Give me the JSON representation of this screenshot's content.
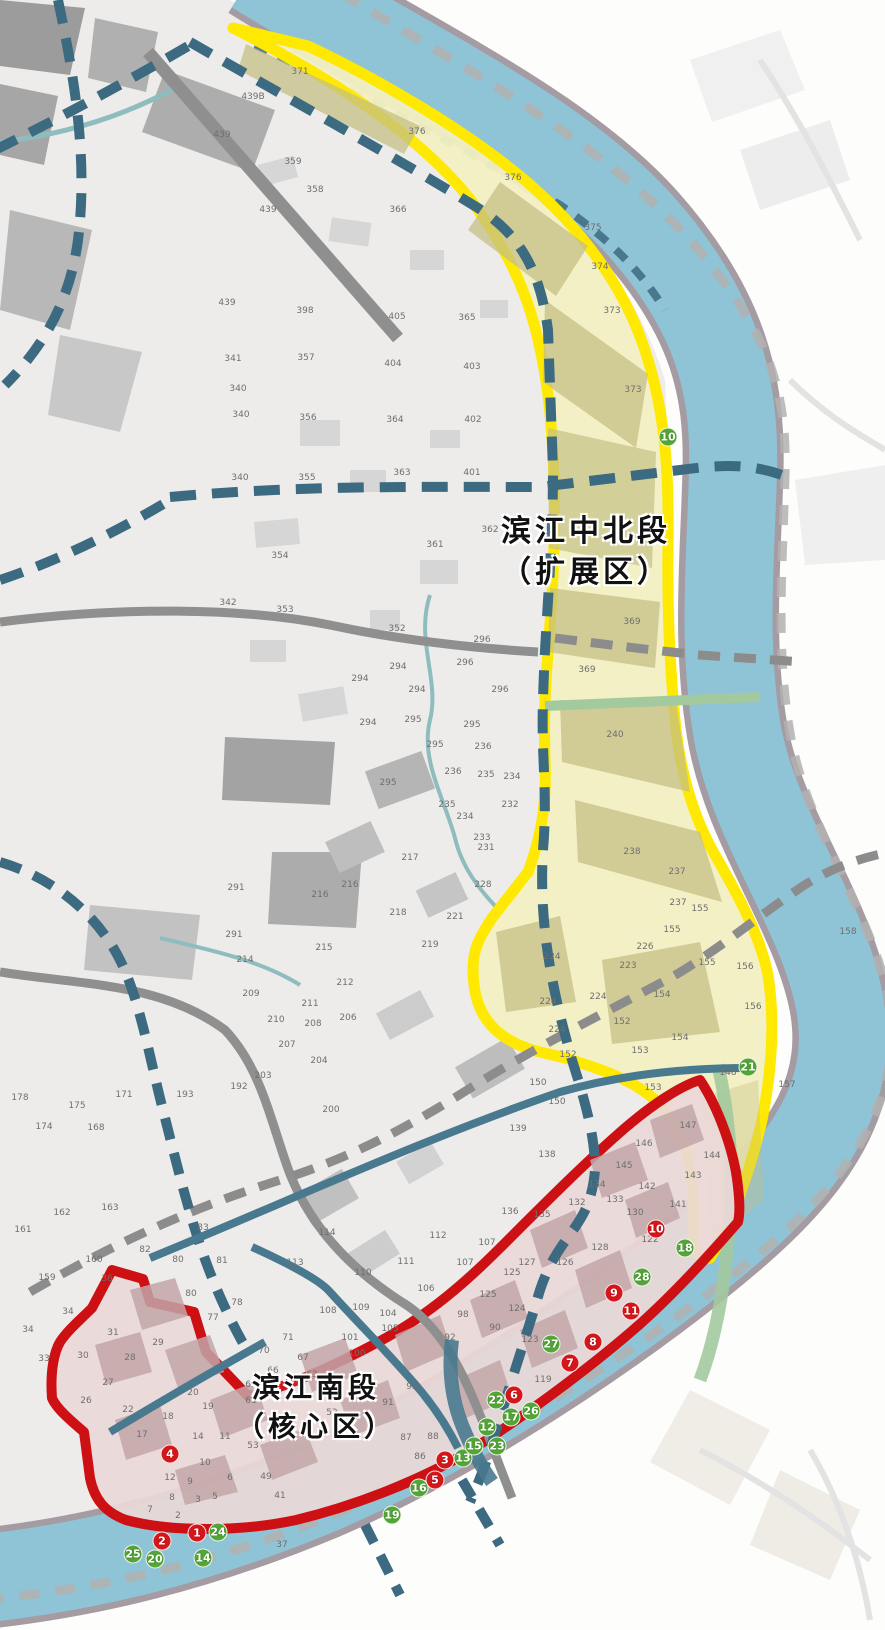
{
  "zones": [
    {
      "id": "north",
      "name_line1": "滨江中北段",
      "name_line2": "（扩展区）"
    },
    {
      "id": "south",
      "name_line1": "滨江南段",
      "name_line2": "（核心区）"
    }
  ],
  "colors": {
    "river": "#8FC3D6",
    "shore": "#A49BA3",
    "far_bank_dash": "#B3B1B0",
    "map_base": "#EDECEA",
    "zone_north_border": "#FFE802",
    "zone_north_fill": "#F1EFC2",
    "zone_north_block": "#C6C186",
    "zone_south_border": "#CC1014",
    "zone_south_fill": "#EBD8D8",
    "zone_south_block": "#C3A6A8",
    "road_dashed_blue": "#3C6A81",
    "road_gray": "#8F8F8F",
    "road_dashed_gray": "#8C8C8C",
    "road_teal": "#48798E",
    "canal": "#8FBCBE",
    "green_strip": "#A3C99F",
    "marker_red": "#D5161A",
    "marker_green": "#53A637",
    "parcel_text": "#6F6F6F",
    "zone_label_text": "#111111"
  },
  "markers": {
    "red": [
      {
        "n": "1",
        "x": 197,
        "y": 1533
      },
      {
        "n": "2",
        "x": 162,
        "y": 1541
      },
      {
        "n": "3",
        "x": 445,
        "y": 1460
      },
      {
        "n": "4",
        "x": 170,
        "y": 1454
      },
      {
        "n": "5",
        "x": 435,
        "y": 1480
      },
      {
        "n": "6",
        "x": 514,
        "y": 1395
      },
      {
        "n": "7",
        "x": 570,
        "y": 1363
      },
      {
        "n": "8",
        "x": 593,
        "y": 1342
      },
      {
        "n": "9",
        "x": 614,
        "y": 1293
      },
      {
        "n": "10",
        "x": 656,
        "y": 1229
      },
      {
        "n": "11",
        "x": 631,
        "y": 1311
      }
    ],
    "green": [
      {
        "n": "10",
        "x": 668,
        "y": 437
      },
      {
        "n": "12",
        "x": 487,
        "y": 1427
      },
      {
        "n": "13",
        "x": 463,
        "y": 1458
      },
      {
        "n": "14",
        "x": 203,
        "y": 1558
      },
      {
        "n": "15",
        "x": 474,
        "y": 1446
      },
      {
        "n": "16",
        "x": 419,
        "y": 1488
      },
      {
        "n": "17",
        "x": 511,
        "y": 1417
      },
      {
        "n": "18",
        "x": 685,
        "y": 1248
      },
      {
        "n": "19",
        "x": 392,
        "y": 1515
      },
      {
        "n": "20",
        "x": 155,
        "y": 1559
      },
      {
        "n": "21",
        "x": 748,
        "y": 1067
      },
      {
        "n": "22",
        "x": 496,
        "y": 1400
      },
      {
        "n": "23",
        "x": 497,
        "y": 1446
      },
      {
        "n": "24",
        "x": 218,
        "y": 1532
      },
      {
        "n": "25",
        "x": 133,
        "y": 1554
      },
      {
        "n": "26",
        "x": 531,
        "y": 1411
      },
      {
        "n": "27",
        "x": 551,
        "y": 1344
      },
      {
        "n": "28",
        "x": 642,
        "y": 1277
      }
    ]
  },
  "parcel_labels": [
    {
      "t": "439B",
      "x": 253,
      "y": 97
    },
    {
      "t": "439",
      "x": 222,
      "y": 135
    },
    {
      "t": "359",
      "x": 293,
      "y": 162
    },
    {
      "t": "358",
      "x": 315,
      "y": 190
    },
    {
      "t": "439",
      "x": 268,
      "y": 210
    },
    {
      "t": "366",
      "x": 398,
      "y": 210
    },
    {
      "t": "376",
      "x": 417,
      "y": 132
    },
    {
      "t": "376",
      "x": 513,
      "y": 178
    },
    {
      "t": "375",
      "x": 593,
      "y": 228
    },
    {
      "t": "374",
      "x": 600,
      "y": 267
    },
    {
      "t": "373",
      "x": 612,
      "y": 311
    },
    {
      "t": "373",
      "x": 633,
      "y": 390
    },
    {
      "t": "371",
      "x": 300,
      "y": 72
    },
    {
      "t": "439",
      "x": 227,
      "y": 303
    },
    {
      "t": "398",
      "x": 305,
      "y": 311
    },
    {
      "t": "405",
      "x": 397,
      "y": 317
    },
    {
      "t": "365",
      "x": 467,
      "y": 318
    },
    {
      "t": "341",
      "x": 233,
      "y": 359
    },
    {
      "t": "357",
      "x": 306,
      "y": 358
    },
    {
      "t": "404",
      "x": 393,
      "y": 364
    },
    {
      "t": "403",
      "x": 472,
      "y": 367
    },
    {
      "t": "340",
      "x": 238,
      "y": 389
    },
    {
      "t": "340",
      "x": 241,
      "y": 415
    },
    {
      "t": "356",
      "x": 308,
      "y": 418
    },
    {
      "t": "364",
      "x": 395,
      "y": 420
    },
    {
      "t": "402",
      "x": 473,
      "y": 420
    },
    {
      "t": "340",
      "x": 240,
      "y": 478
    },
    {
      "t": "355",
      "x": 307,
      "y": 478
    },
    {
      "t": "363",
      "x": 402,
      "y": 473
    },
    {
      "t": "401",
      "x": 472,
      "y": 473
    },
    {
      "t": "354",
      "x": 280,
      "y": 556
    },
    {
      "t": "353",
      "x": 285,
      "y": 610
    },
    {
      "t": "342",
      "x": 228,
      "y": 603
    },
    {
      "t": "362",
      "x": 490,
      "y": 530
    },
    {
      "t": "361",
      "x": 435,
      "y": 545
    },
    {
      "t": "372",
      "x": 653,
      "y": 529
    },
    {
      "t": "352",
      "x": 397,
      "y": 629
    },
    {
      "t": "296",
      "x": 482,
      "y": 640
    },
    {
      "t": "296",
      "x": 465,
      "y": 663
    },
    {
      "t": "296",
      "x": 500,
      "y": 690
    },
    {
      "t": "294",
      "x": 398,
      "y": 667
    },
    {
      "t": "294",
      "x": 360,
      "y": 679
    },
    {
      "t": "294",
      "x": 417,
      "y": 690
    },
    {
      "t": "294",
      "x": 368,
      "y": 723
    },
    {
      "t": "295",
      "x": 413,
      "y": 720
    },
    {
      "t": "295",
      "x": 472,
      "y": 725
    },
    {
      "t": "295",
      "x": 435,
      "y": 745
    },
    {
      "t": "295",
      "x": 388,
      "y": 783
    },
    {
      "t": "236",
      "x": 483,
      "y": 747
    },
    {
      "t": "236",
      "x": 453,
      "y": 772
    },
    {
      "t": "235",
      "x": 486,
      "y": 775
    },
    {
      "t": "235",
      "x": 447,
      "y": 805
    },
    {
      "t": "234",
      "x": 512,
      "y": 777
    },
    {
      "t": "234",
      "x": 465,
      "y": 817
    },
    {
      "t": "233",
      "x": 482,
      "y": 838
    },
    {
      "t": "232",
      "x": 510,
      "y": 805
    },
    {
      "t": "217",
      "x": 410,
      "y": 858
    },
    {
      "t": "231",
      "x": 486,
      "y": 848
    },
    {
      "t": "216",
      "x": 350,
      "y": 885
    },
    {
      "t": "218",
      "x": 398,
      "y": 913
    },
    {
      "t": "221",
      "x": 455,
      "y": 917
    },
    {
      "t": "219",
      "x": 430,
      "y": 945
    },
    {
      "t": "228",
      "x": 483,
      "y": 885
    },
    {
      "t": "369",
      "x": 587,
      "y": 670
    },
    {
      "t": "369",
      "x": 632,
      "y": 622
    },
    {
      "t": "240",
      "x": 615,
      "y": 735
    },
    {
      "t": "238",
      "x": 632,
      "y": 852
    },
    {
      "t": "237",
      "x": 677,
      "y": 872
    },
    {
      "t": "237",
      "x": 678,
      "y": 903
    },
    {
      "t": "155",
      "x": 700,
      "y": 909
    },
    {
      "t": "155",
      "x": 672,
      "y": 930
    },
    {
      "t": "155",
      "x": 707,
      "y": 963
    },
    {
      "t": "156",
      "x": 745,
      "y": 967
    },
    {
      "t": "156",
      "x": 753,
      "y": 1007
    },
    {
      "t": "158",
      "x": 848,
      "y": 932
    },
    {
      "t": "157",
      "x": 787,
      "y": 1085
    },
    {
      "t": "224",
      "x": 552,
      "y": 957
    },
    {
      "t": "224",
      "x": 548,
      "y": 1002
    },
    {
      "t": "224",
      "x": 598,
      "y": 997
    },
    {
      "t": "224",
      "x": 557,
      "y": 1030
    },
    {
      "t": "223",
      "x": 628,
      "y": 966
    },
    {
      "t": "226",
      "x": 645,
      "y": 947
    },
    {
      "t": "152",
      "x": 622,
      "y": 1022
    },
    {
      "t": "152",
      "x": 568,
      "y": 1055
    },
    {
      "t": "153",
      "x": 640,
      "y": 1051
    },
    {
      "t": "153",
      "x": 653,
      "y": 1088
    },
    {
      "t": "154",
      "x": 662,
      "y": 995
    },
    {
      "t": "154",
      "x": 680,
      "y": 1038
    },
    {
      "t": "150",
      "x": 538,
      "y": 1083
    },
    {
      "t": "150",
      "x": 557,
      "y": 1102
    },
    {
      "t": "148",
      "x": 728,
      "y": 1073
    },
    {
      "t": "291",
      "x": 236,
      "y": 888
    },
    {
      "t": "291",
      "x": 234,
      "y": 935
    },
    {
      "t": "214",
      "x": 245,
      "y": 960
    },
    {
      "t": "215",
      "x": 324,
      "y": 948
    },
    {
      "t": "216",
      "x": 320,
      "y": 895
    },
    {
      "t": "212",
      "x": 345,
      "y": 983
    },
    {
      "t": "209",
      "x": 251,
      "y": 994
    },
    {
      "t": "210",
      "x": 276,
      "y": 1020
    },
    {
      "t": "211",
      "x": 310,
      "y": 1004
    },
    {
      "t": "208",
      "x": 313,
      "y": 1024
    },
    {
      "t": "207",
      "x": 287,
      "y": 1045
    },
    {
      "t": "206",
      "x": 348,
      "y": 1018
    },
    {
      "t": "204",
      "x": 319,
      "y": 1061
    },
    {
      "t": "203",
      "x": 263,
      "y": 1076
    },
    {
      "t": "200",
      "x": 331,
      "y": 1110
    },
    {
      "t": "193",
      "x": 185,
      "y": 1095
    },
    {
      "t": "192",
      "x": 239,
      "y": 1087
    },
    {
      "t": "171",
      "x": 124,
      "y": 1095
    },
    {
      "t": "175",
      "x": 77,
      "y": 1106
    },
    {
      "t": "178",
      "x": 20,
      "y": 1098
    },
    {
      "t": "174",
      "x": 44,
      "y": 1127
    },
    {
      "t": "168",
      "x": 96,
      "y": 1128
    },
    {
      "t": "162",
      "x": 62,
      "y": 1213
    },
    {
      "t": "163",
      "x": 110,
      "y": 1208
    },
    {
      "t": "161",
      "x": 23,
      "y": 1230
    },
    {
      "t": "159",
      "x": 47,
      "y": 1278
    },
    {
      "t": "160",
      "x": 94,
      "y": 1260
    },
    {
      "t": "36",
      "x": 107,
      "y": 1279
    },
    {
      "t": "34",
      "x": 68,
      "y": 1312
    },
    {
      "t": "34",
      "x": 28,
      "y": 1330
    },
    {
      "t": "80",
      "x": 178,
      "y": 1260
    },
    {
      "t": "80",
      "x": 191,
      "y": 1294
    },
    {
      "t": "81",
      "x": 222,
      "y": 1261
    },
    {
      "t": "78",
      "x": 237,
      "y": 1303
    },
    {
      "t": "77",
      "x": 213,
      "y": 1318
    },
    {
      "t": "83",
      "x": 203,
      "y": 1228
    },
    {
      "t": "82",
      "x": 145,
      "y": 1250
    },
    {
      "t": "31",
      "x": 113,
      "y": 1333
    },
    {
      "t": "30",
      "x": 83,
      "y": 1356
    },
    {
      "t": "33",
      "x": 44,
      "y": 1359
    },
    {
      "t": "29",
      "x": 158,
      "y": 1343
    },
    {
      "t": "28",
      "x": 130,
      "y": 1358
    },
    {
      "t": "27",
      "x": 108,
      "y": 1383
    },
    {
      "t": "26",
      "x": 86,
      "y": 1401
    },
    {
      "t": "22",
      "x": 128,
      "y": 1410
    },
    {
      "t": "18",
      "x": 168,
      "y": 1417
    },
    {
      "t": "19",
      "x": 208,
      "y": 1407
    },
    {
      "t": "20",
      "x": 193,
      "y": 1393
    },
    {
      "t": "113",
      "x": 295,
      "y": 1263
    },
    {
      "t": "114",
      "x": 327,
      "y": 1233
    },
    {
      "t": "110",
      "x": 363,
      "y": 1273
    },
    {
      "t": "112",
      "x": 438,
      "y": 1236
    },
    {
      "t": "111",
      "x": 406,
      "y": 1262
    },
    {
      "t": "107",
      "x": 487,
      "y": 1243
    },
    {
      "t": "107",
      "x": 465,
      "y": 1263
    },
    {
      "t": "106",
      "x": 426,
      "y": 1289
    },
    {
      "t": "108",
      "x": 328,
      "y": 1311
    },
    {
      "t": "109",
      "x": 361,
      "y": 1308
    },
    {
      "t": "104",
      "x": 388,
      "y": 1314
    },
    {
      "t": "105",
      "x": 390,
      "y": 1329
    },
    {
      "t": "101",
      "x": 350,
      "y": 1338
    },
    {
      "t": "100",
      "x": 357,
      "y": 1354
    },
    {
      "t": "71",
      "x": 288,
      "y": 1338
    },
    {
      "t": "70",
      "x": 264,
      "y": 1351
    },
    {
      "t": "67",
      "x": 303,
      "y": 1358
    },
    {
      "t": "66",
      "x": 273,
      "y": 1371
    },
    {
      "t": "63",
      "x": 312,
      "y": 1375
    },
    {
      "t": "65",
      "x": 251,
      "y": 1385
    },
    {
      "t": "61",
      "x": 251,
      "y": 1401
    },
    {
      "t": "52",
      "x": 332,
      "y": 1413
    },
    {
      "t": "93",
      "x": 412,
      "y": 1387
    },
    {
      "t": "91",
      "x": 388,
      "y": 1403
    },
    {
      "t": "92",
      "x": 450,
      "y": 1338
    },
    {
      "t": "88",
      "x": 433,
      "y": 1437
    },
    {
      "t": "87",
      "x": 406,
      "y": 1438
    },
    {
      "t": "86",
      "x": 420,
      "y": 1457
    },
    {
      "t": "125",
      "x": 512,
      "y": 1273
    },
    {
      "t": "125",
      "x": 488,
      "y": 1295
    },
    {
      "t": "124",
      "x": 517,
      "y": 1309
    },
    {
      "t": "98",
      "x": 463,
      "y": 1315
    },
    {
      "t": "90",
      "x": 495,
      "y": 1328
    },
    {
      "t": "123",
      "x": 530,
      "y": 1340
    },
    {
      "t": "119",
      "x": 543,
      "y": 1380
    },
    {
      "t": "147",
      "x": 688,
      "y": 1126
    },
    {
      "t": "146",
      "x": 644,
      "y": 1144
    },
    {
      "t": "144",
      "x": 712,
      "y": 1156
    },
    {
      "t": "145",
      "x": 624,
      "y": 1166
    },
    {
      "t": "143",
      "x": 693,
      "y": 1176
    },
    {
      "t": "142",
      "x": 647,
      "y": 1187
    },
    {
      "t": "134",
      "x": 597,
      "y": 1185
    },
    {
      "t": "133",
      "x": 615,
      "y": 1200
    },
    {
      "t": "141",
      "x": 678,
      "y": 1205
    },
    {
      "t": "130",
      "x": 635,
      "y": 1213
    },
    {
      "t": "132",
      "x": 577,
      "y": 1203
    },
    {
      "t": "138",
      "x": 547,
      "y": 1155
    },
    {
      "t": "139",
      "x": 518,
      "y": 1129
    },
    {
      "t": "136",
      "x": 510,
      "y": 1212
    },
    {
      "t": "135",
      "x": 542,
      "y": 1215
    },
    {
      "t": "128",
      "x": 600,
      "y": 1248
    },
    {
      "t": "126",
      "x": 565,
      "y": 1263
    },
    {
      "t": "127",
      "x": 527,
      "y": 1263
    },
    {
      "t": "122",
      "x": 650,
      "y": 1240
    },
    {
      "t": "17",
      "x": 142,
      "y": 1435
    },
    {
      "t": "14",
      "x": 198,
      "y": 1437
    },
    {
      "t": "11",
      "x": 225,
      "y": 1437
    },
    {
      "t": "53",
      "x": 253,
      "y": 1446
    },
    {
      "t": "10",
      "x": 205,
      "y": 1463
    },
    {
      "t": "9",
      "x": 190,
      "y": 1482
    },
    {
      "t": "6",
      "x": 230,
      "y": 1478
    },
    {
      "t": "5",
      "x": 215,
      "y": 1497
    },
    {
      "t": "12",
      "x": 170,
      "y": 1478
    },
    {
      "t": "8",
      "x": 172,
      "y": 1498
    },
    {
      "t": "7",
      "x": 150,
      "y": 1510
    },
    {
      "t": "3",
      "x": 198,
      "y": 1500
    },
    {
      "t": "2",
      "x": 178,
      "y": 1516
    },
    {
      "t": "41",
      "x": 280,
      "y": 1496
    },
    {
      "t": "37",
      "x": 282,
      "y": 1545
    },
    {
      "t": "49",
      "x": 266,
      "y": 1477
    }
  ]
}
